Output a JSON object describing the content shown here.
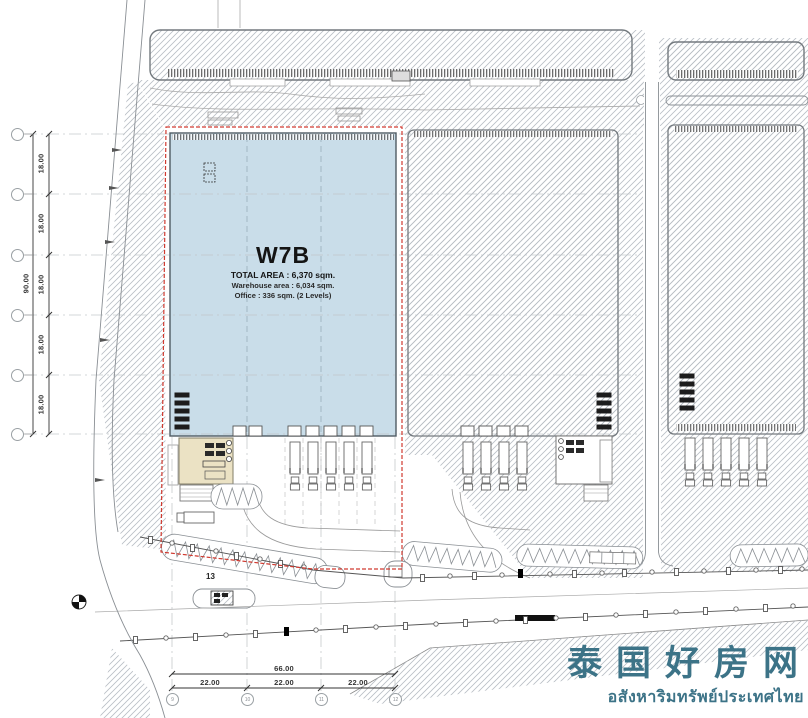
{
  "title_block": {
    "unit": "W7B",
    "total_area": "TOTAL AREA : 6,370 sqm.",
    "warehouse_area": "Warehouse area : 6,034 sqm.",
    "office_area": "Office : 336 sqm. (2 Levels)"
  },
  "dimensions": {
    "left_total": "90.00",
    "left_segments": [
      "18.00",
      "18.00",
      "18.00",
      "18.00",
      "18.00"
    ],
    "bottom_total": "66.00",
    "bottom_segments": [
      "22.00",
      "22.00",
      "22.00"
    ],
    "road_marker": "13"
  },
  "grid_bubbles": {
    "bottom": [
      "9",
      "10",
      "11",
      "12"
    ]
  },
  "watermark": {
    "title": "泰国好房网",
    "subtitle": "อสังหาริมทรัพย์ประเทศไทย"
  },
  "colors": {
    "warehouse_fill": "#c9dde9",
    "office_fill": "#ebe2c4",
    "boundary": "#d03a30",
    "watermark": "#3c7387"
  }
}
